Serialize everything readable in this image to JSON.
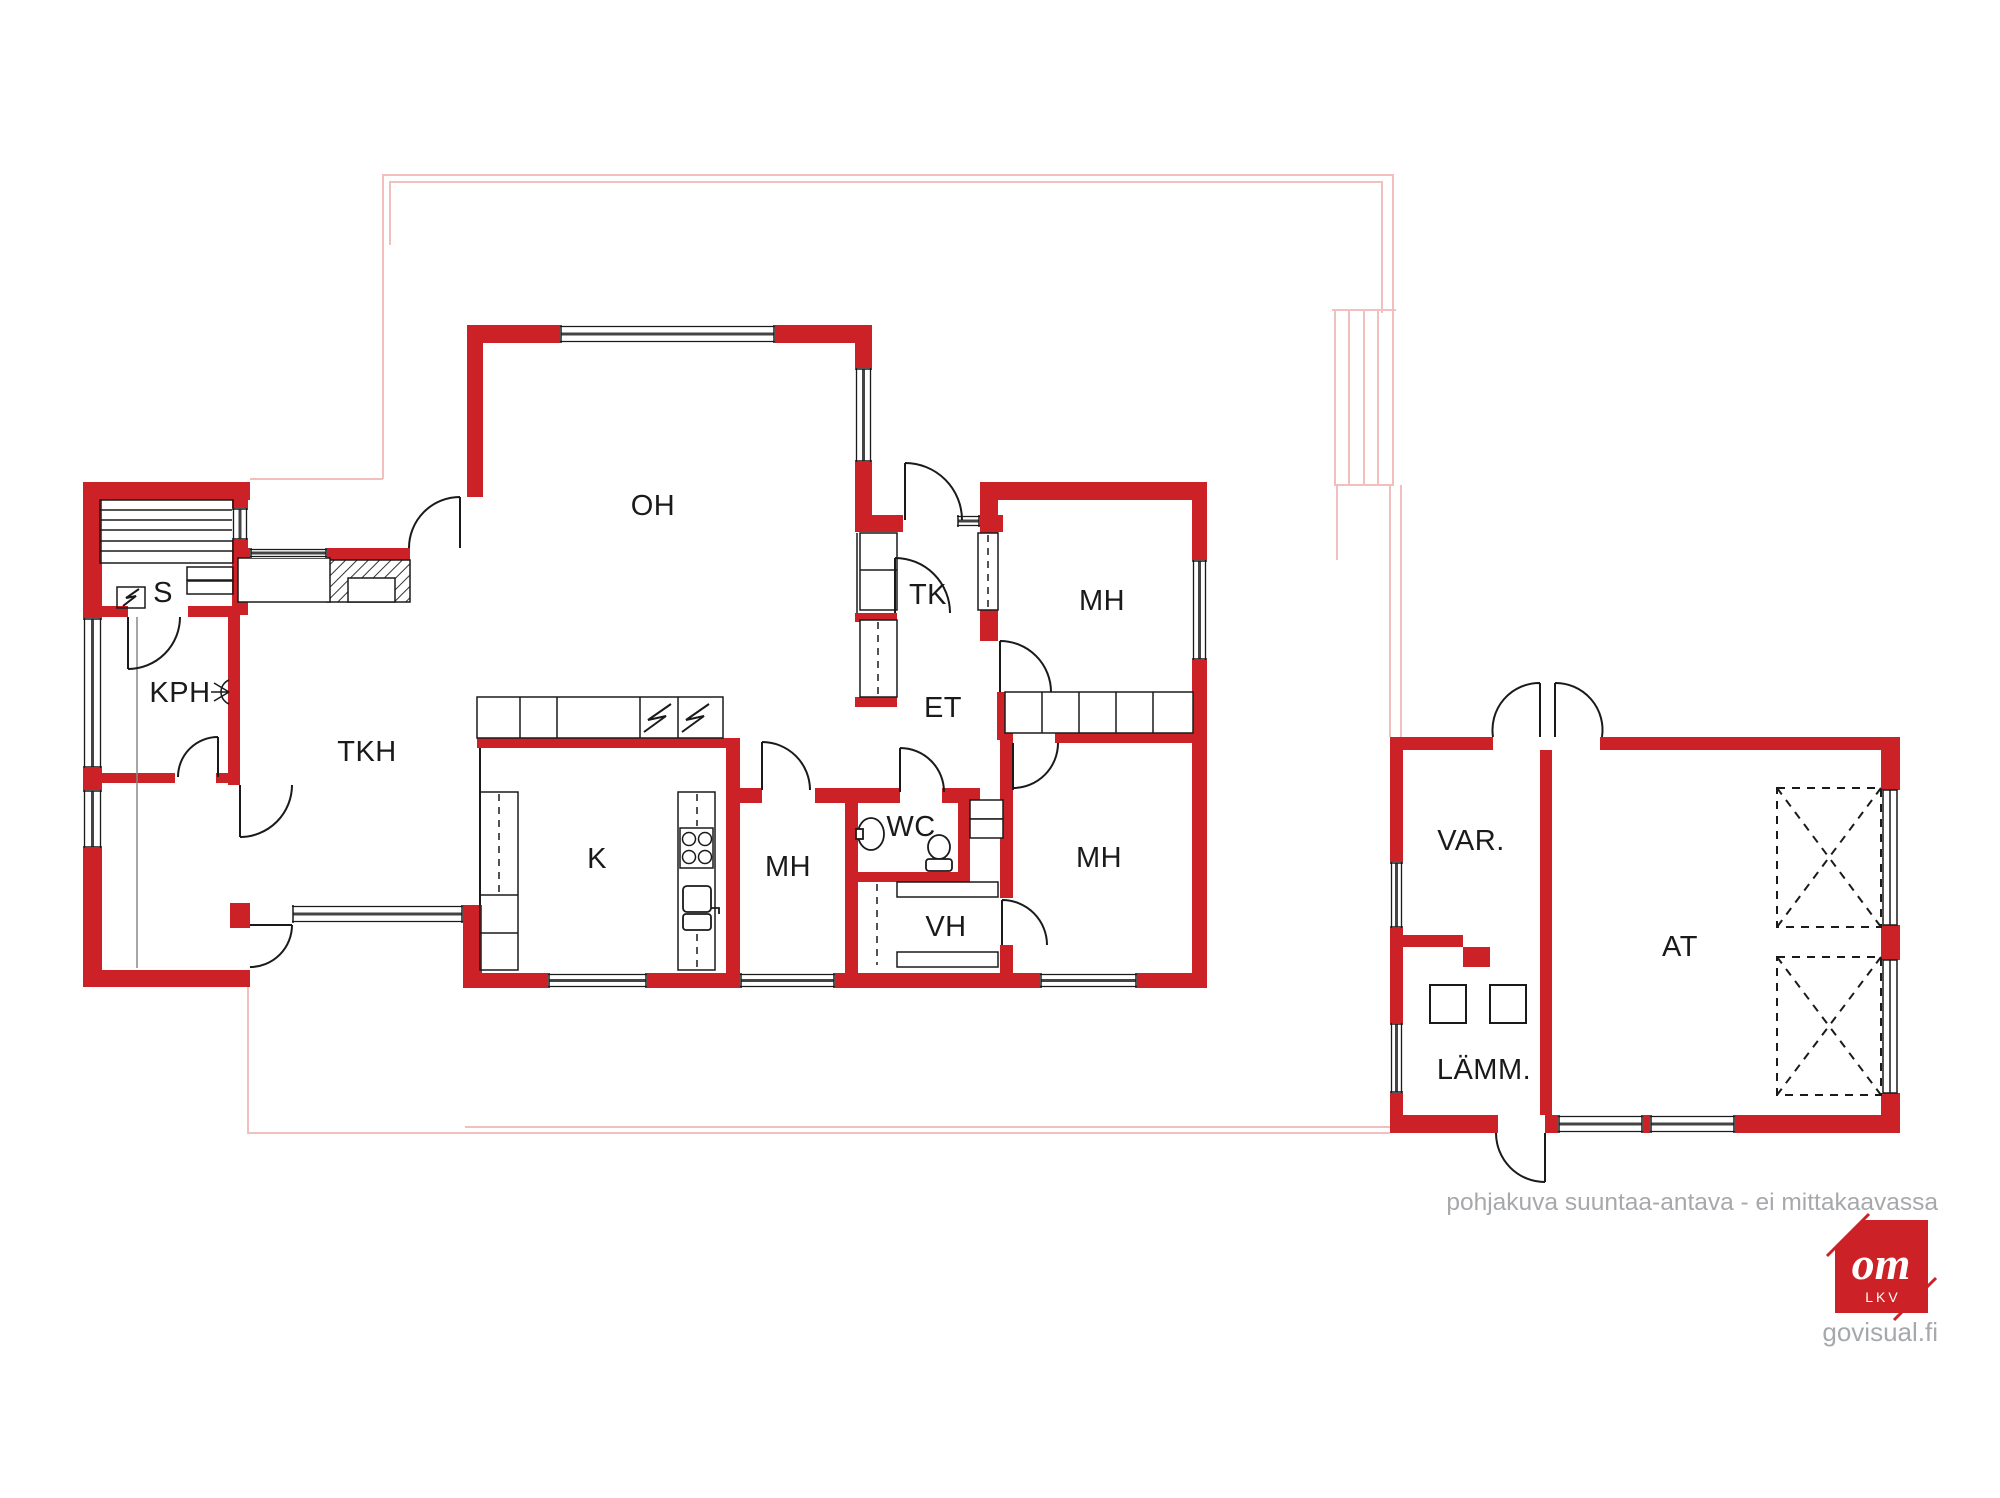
{
  "plan": {
    "room_labels": [
      {
        "id": "oh",
        "label": "OH"
      },
      {
        "id": "tk",
        "label": "TK"
      },
      {
        "id": "mh-ne",
        "label": "MH"
      },
      {
        "id": "et",
        "label": "ET"
      },
      {
        "id": "s",
        "label": "S"
      },
      {
        "id": "kph",
        "label": "KPH"
      },
      {
        "id": "tkh",
        "label": "TKH"
      },
      {
        "id": "k",
        "label": "K"
      },
      {
        "id": "mh-mid",
        "label": "MH"
      },
      {
        "id": "wc",
        "label": "WC"
      },
      {
        "id": "vh",
        "label": "VH"
      },
      {
        "id": "mh-se",
        "label": "MH"
      },
      {
        "id": "var",
        "label": "VAR."
      },
      {
        "id": "at",
        "label": "AT"
      },
      {
        "id": "lamm",
        "label": "LÄMM."
      }
    ]
  },
  "footer": {
    "disclaimer": "pohjakuva suuntaa-antava - ei mittakaavassa",
    "website": "govisual.fi"
  },
  "logo": {
    "monogram": "om",
    "subtitle": "LKV"
  },
  "colors": {
    "wall_red": "#cc2127",
    "outline_pink": "#f2bfbf",
    "line_black": "#1a1a1a",
    "text_gray": "#a6a8ab"
  }
}
